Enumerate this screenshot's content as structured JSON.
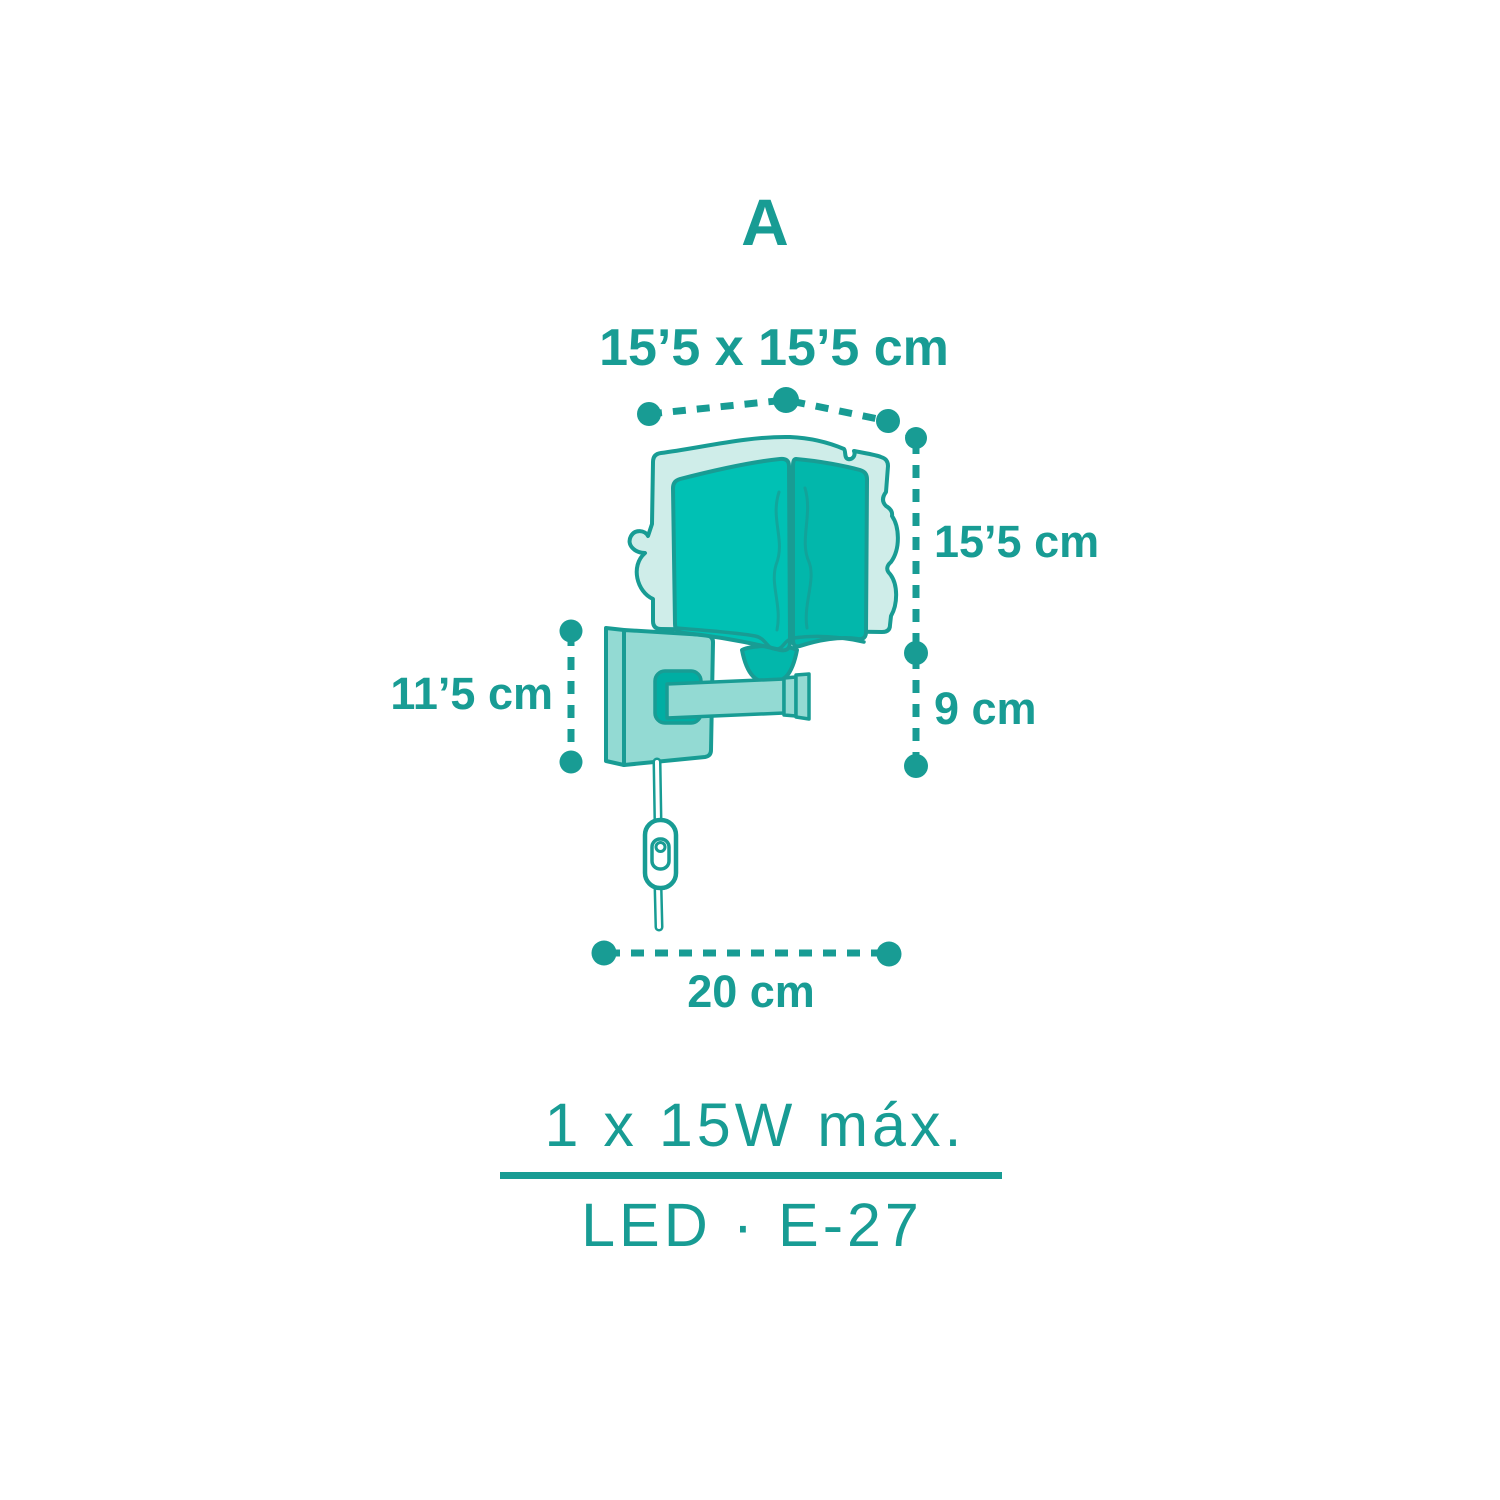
{
  "colors": {
    "accent": "#189c94",
    "fill-bright": "#00c1b4",
    "fill-bright-side": "#02b7ab",
    "fill-dark": "#00aea3",
    "fill-plate": "#93dad3",
    "fill-pale": "#cfede9",
    "paper": "#ffffff"
  },
  "figure": {
    "view_label": "A",
    "subject": "wall-lamp-dimension-diagram"
  },
  "dimensions": {
    "top_width": "15’5 x 15’5 cm",
    "shade_height": "15’5 cm",
    "drop_height": "9 cm",
    "backplate_height": "11’5 cm",
    "total_depth": "20 cm"
  },
  "specs": {
    "power": "1 x 15W máx.",
    "socket": "LED · E-27"
  }
}
